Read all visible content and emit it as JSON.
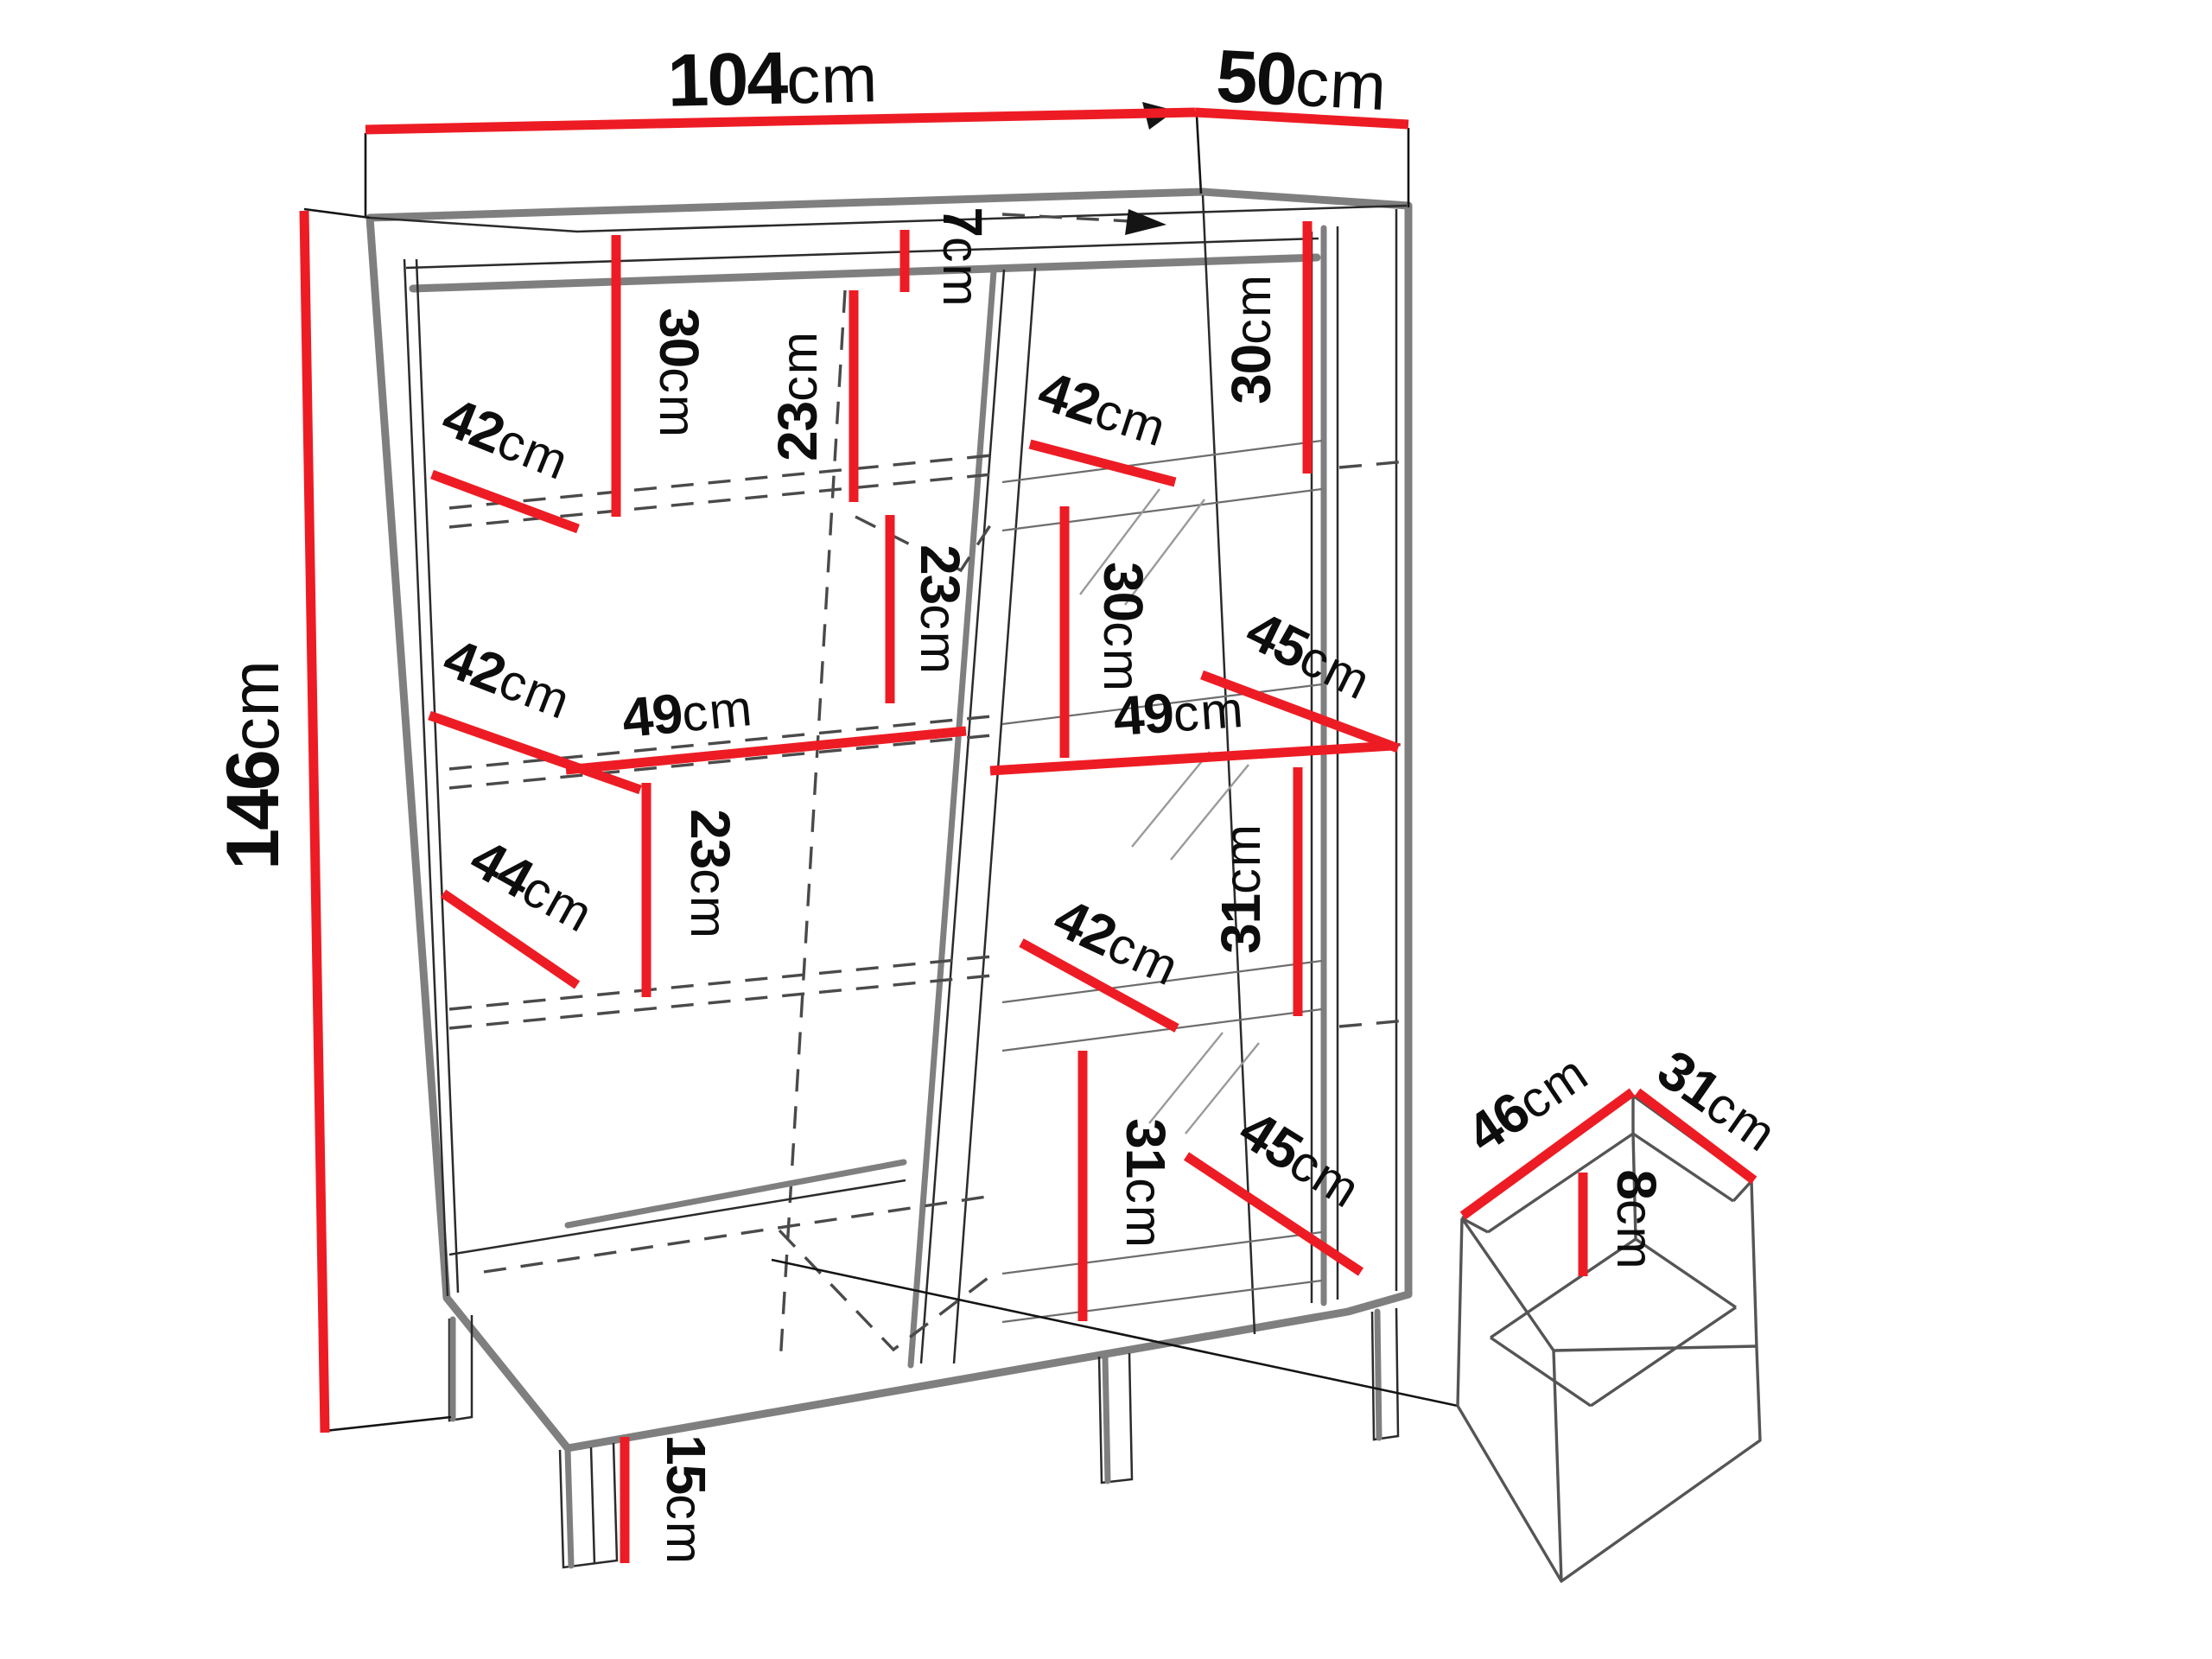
{
  "diagram": {
    "kind": "furniture-dimension-drawing",
    "unit": "cm",
    "colors": {
      "accent": "#ed1c24",
      "outline": "#7f7f7f",
      "ink": "#111111"
    }
  },
  "dims": {
    "width": {
      "num": "104",
      "unit": "cm"
    },
    "depth": {
      "num": "50",
      "unit": "cm"
    },
    "height": {
      "num": "146",
      "unit": "cm"
    },
    "top_gap": {
      "num": "7",
      "unit": "cm"
    },
    "leg": {
      "num": "15",
      "unit": "cm"
    },
    "left": {
      "s30": {
        "num": "30",
        "unit": "cm"
      },
      "d42a": {
        "num": "42",
        "unit": "cm"
      },
      "s23a": {
        "num": "23",
        "unit": "cm"
      },
      "s23b": {
        "num": "23",
        "unit": "cm"
      },
      "w49": {
        "num": "49",
        "unit": "cm"
      },
      "d42b": {
        "num": "42",
        "unit": "cm"
      },
      "s23c": {
        "num": "23",
        "unit": "cm"
      },
      "d44": {
        "num": "44",
        "unit": "cm"
      }
    },
    "right": {
      "s30a": {
        "num": "30",
        "unit": "cm"
      },
      "d42a": {
        "num": "42",
        "unit": "cm"
      },
      "s30b": {
        "num": "30",
        "unit": "cm"
      },
      "d45a": {
        "num": "45",
        "unit": "cm"
      },
      "w49": {
        "num": "49",
        "unit": "cm"
      },
      "s31a": {
        "num": "31",
        "unit": "cm"
      },
      "d42b": {
        "num": "42",
        "unit": "cm"
      },
      "s31b": {
        "num": "31",
        "unit": "cm"
      },
      "d45b": {
        "num": "45",
        "unit": "cm"
      }
    },
    "drawer": {
      "width": {
        "num": "46",
        "unit": "cm"
      },
      "depth": {
        "num": "31",
        "unit": "cm"
      },
      "height": {
        "num": "8",
        "unit": "cm"
      }
    }
  }
}
